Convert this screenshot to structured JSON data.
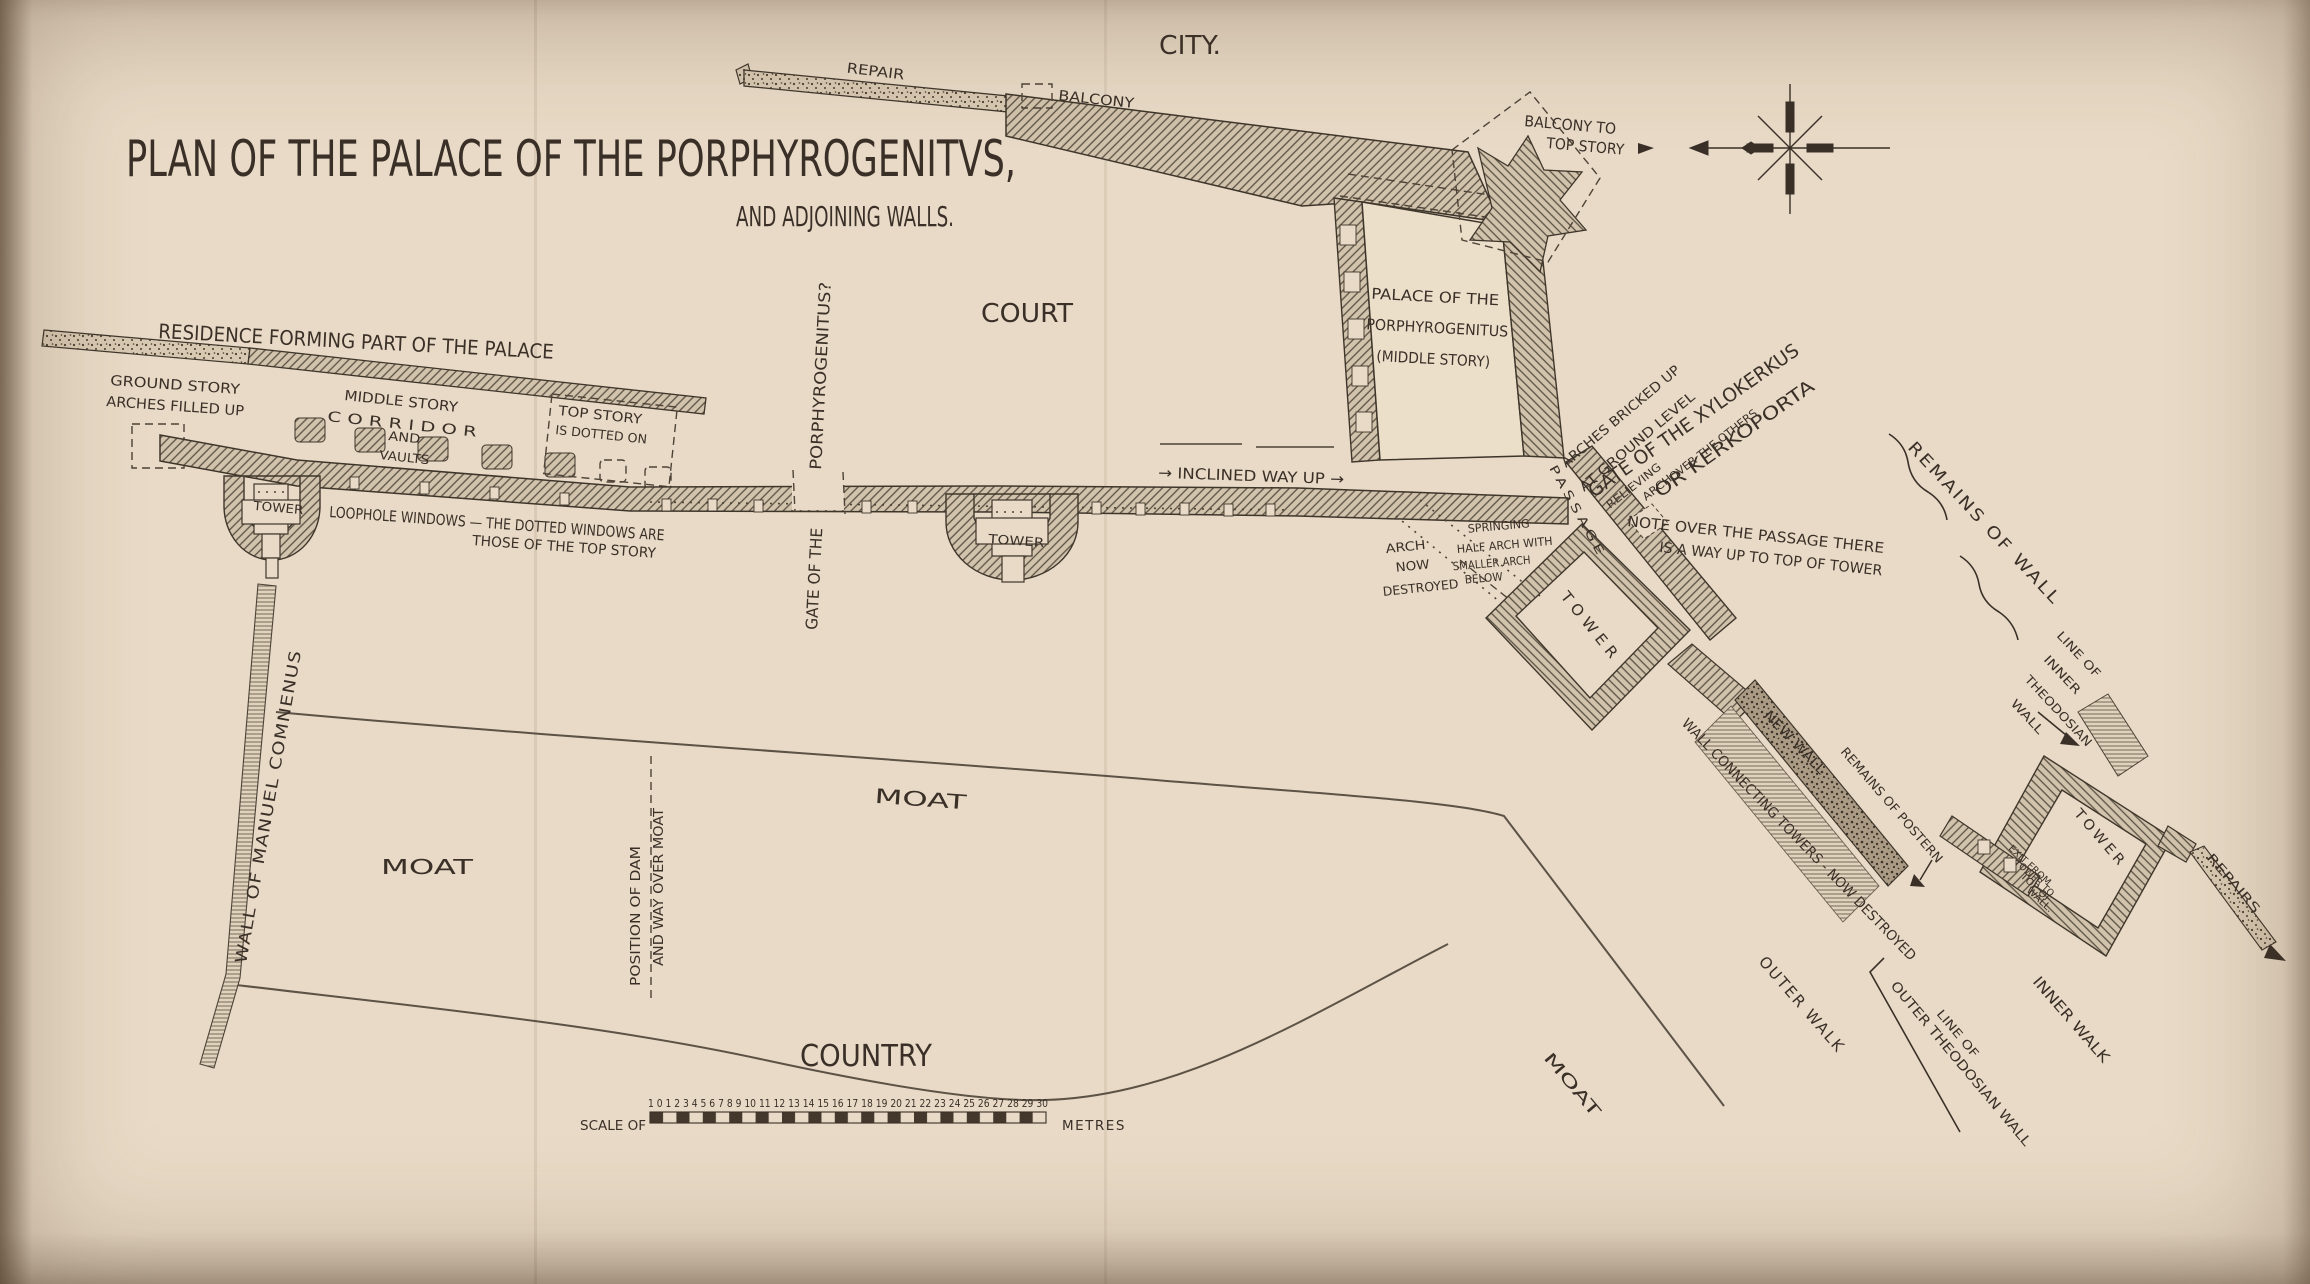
{
  "title": {
    "main": "PLAN OF THE PALACE OF THE PORPHYROGENITVS,",
    "sub": "AND ADJOINING WALLS."
  },
  "regions": {
    "city": "CITY.",
    "court": "COURT",
    "country": "COUNTRY",
    "moat_left": "MOAT",
    "moat_middle": "MOAT",
    "moat_lower_right": "MOAT"
  },
  "labels": {
    "repair_top": "REPAIR",
    "balcony_top": "BALCONY",
    "balcony_to_top_story": [
      "BALCONY TO",
      "TOP STORY"
    ],
    "residence": "RESIDENCE FORMING PART OF THE PALACE",
    "ground_story": [
      "GROUND STORY",
      "ARCHES FILLED UP"
    ],
    "middle_story": [
      "MIDDLE STORY",
      "C O R R I D O R",
      "AND",
      "VAULTS"
    ],
    "top_story": [
      "TOP STORY",
      "IS DOTTED ON"
    ],
    "tower_left": "TOWER",
    "loophole_windows": [
      "LOOPHOLE WINDOWS — THE DOTTED WINDOWS ARE",
      "THOSE OF THE TOP STORY"
    ],
    "gate_of_the": "GATE OF THE",
    "porphyrogenitus_q": "PORPHYROGENITUS?",
    "tower_middle": "TOWER",
    "inclined_way": "→ INCLINED WAY UP →",
    "palace_middle_story": [
      "PALACE OF THE",
      "PORPHYROGENITUS",
      "(MIDDLE STORY)"
    ],
    "passage": "PASSAGE",
    "arches_bricked_up": [
      "ARCHES BRICKED UP",
      "AT GROUND LEVEL"
    ],
    "gate_xylokerkus": [
      "GATE OF THE XYLOKERKUS",
      "OR KERKOPORTA"
    ],
    "relieving_arch": [
      "RELIEVING",
      "ARCH",
      "OVER THE OTHERS"
    ],
    "note_passage": [
      "NOTE OVER THE PASSAGE THERE",
      "IS A WAY UP TO TOP OF TOWER"
    ],
    "arch_now_destroyed": [
      "ARCH",
      "NOW",
      "DESTROYED"
    ],
    "springing_half_arch": [
      "SPRINGING",
      "HALF ARCH WITH",
      "SMALLER ARCH",
      "BELOW"
    ],
    "tower_diagonal": "TOWER",
    "remains_of_wall": "REMAINS OF WALL",
    "line_inner_theodosian": [
      "LINE OF",
      "INNER",
      "THEODOSIAN",
      "WALL"
    ],
    "new_wall": "NEW WALL",
    "wall_connecting_towers": "WALL CONNECTING TOWERS - NOW DESTROYED",
    "remains_of_postern": "REMAINS OF POSTERN",
    "outer_walk": "OUTER WALK",
    "line_outer_theodosian": [
      "LINE OF",
      "OUTER THEODOSIAN WALL"
    ],
    "inner_walk": "INNER WALK",
    "tower_bottom_right": "TOWER",
    "exit_from_tower": [
      "EXIT FROM",
      "TOWER TO",
      "TOP OF",
      "WALL."
    ],
    "repairs_right": "REPAIRS",
    "wall_of_manuel": "WALL OF MANUEL COMNENUS",
    "position_of_dam": [
      "POSITION OF DAM",
      "AND WAY OVER MOAT"
    ]
  },
  "scale_bar": {
    "label": "SCALE OF",
    "numbers": "1 0 1 2 3 4 5 6 7 8 9 10 11 12 13 14 15 16 17 18 19 20 21 22 23 24 25 26 27 28 29 30",
    "unit": "METRES"
  },
  "colors": {
    "paper": "#e8dac6",
    "ink": "#3a3028"
  }
}
